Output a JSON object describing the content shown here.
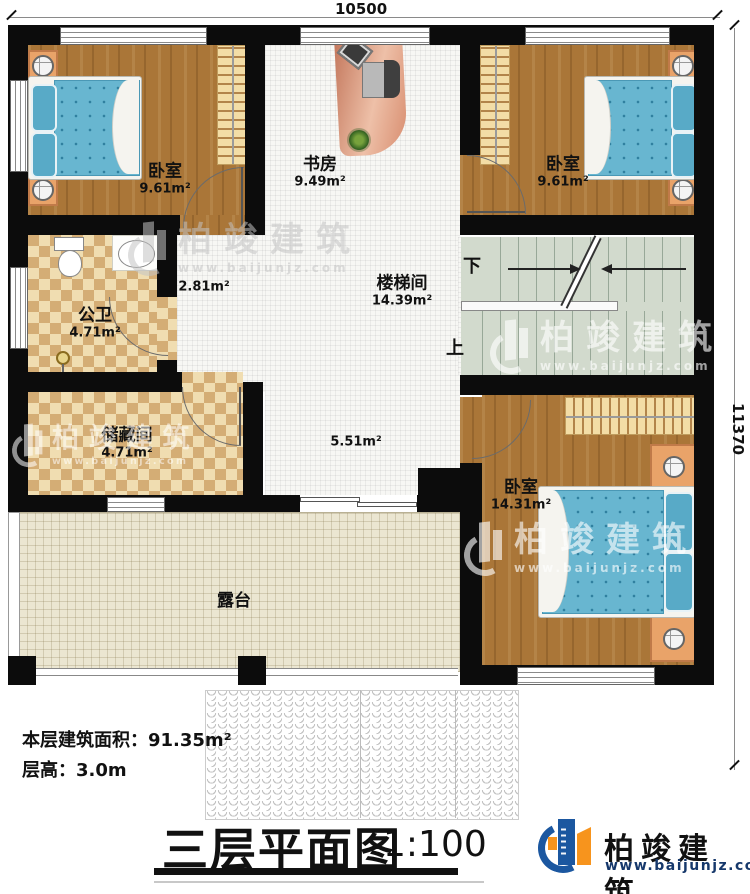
{
  "dimensions": {
    "width": "10500",
    "height": "11370"
  },
  "rooms": {
    "bedroom_tl": {
      "name": "卧室",
      "area": "9.61m²"
    },
    "study": {
      "name": "书房",
      "area": "9.49m²"
    },
    "bedroom_tr": {
      "name": "卧室",
      "area": "9.61m²"
    },
    "bathroom": {
      "name": "公卫",
      "area": "4.71m²"
    },
    "corridor": {
      "area": "2.81m²"
    },
    "stairwell": {
      "name": "楼梯间",
      "area": "14.39m²"
    },
    "storage": {
      "name": "储藏间",
      "area": "4.71m²"
    },
    "hall": {
      "area": "5.51m²"
    },
    "bedroom_br": {
      "name": "卧室",
      "area": "14.31m²"
    },
    "terrace": {
      "name": "露台"
    }
  },
  "stairs": {
    "down": "下",
    "up": "上"
  },
  "info": {
    "area_line": "本层建筑面积：91.35m²",
    "height_line": "层高：3.0m"
  },
  "title": {
    "text": "三层平面图",
    "scale": "1:100"
  },
  "brand": {
    "name": "柏竣建筑",
    "url": "www.baijunjz.com"
  },
  "watermark": {
    "name": "柏竣建筑",
    "url": "www.baijunjz.com"
  },
  "palette": {
    "wall": "#0c0c0c",
    "wood_floor": "#aa7638",
    "tile_floor": "#f7f7f4",
    "checker_light": "#f0ddb1",
    "checker_dark": "#d4ad75",
    "stairs": "#d2dacd",
    "terrace": "#ebe6d1",
    "mattress": "#68b6d0",
    "desk": "#d98f72",
    "nightstand": "#e9a369",
    "logo_blue": "#1b57a0",
    "logo_orange": "#f7941d"
  }
}
